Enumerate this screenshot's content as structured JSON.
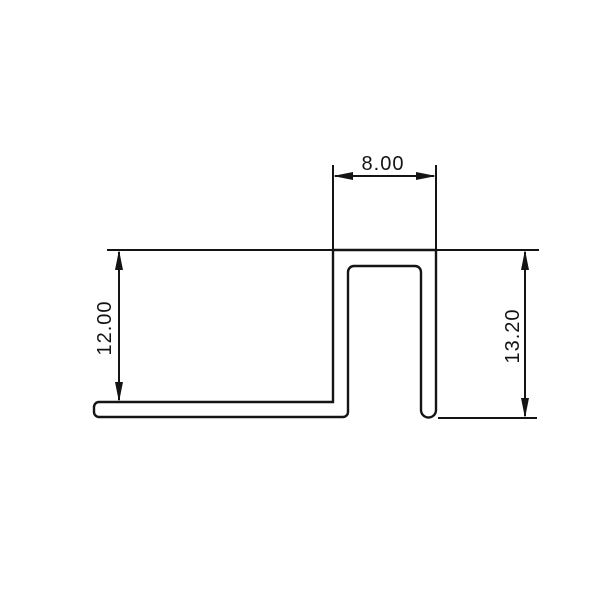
{
  "drawing": {
    "background_color": "#ffffff",
    "line_color": "#141414",
    "kind": "profile-cross-section",
    "dimensions": {
      "top_width": {
        "label": "8.00",
        "value": 8.0,
        "orientation": "horizontal"
      },
      "left_height": {
        "label": "12.00",
        "value": 12.0,
        "orientation": "vertical"
      },
      "right_height": {
        "label": "13.20",
        "value": 13.2,
        "orientation": "vertical"
      }
    }
  }
}
